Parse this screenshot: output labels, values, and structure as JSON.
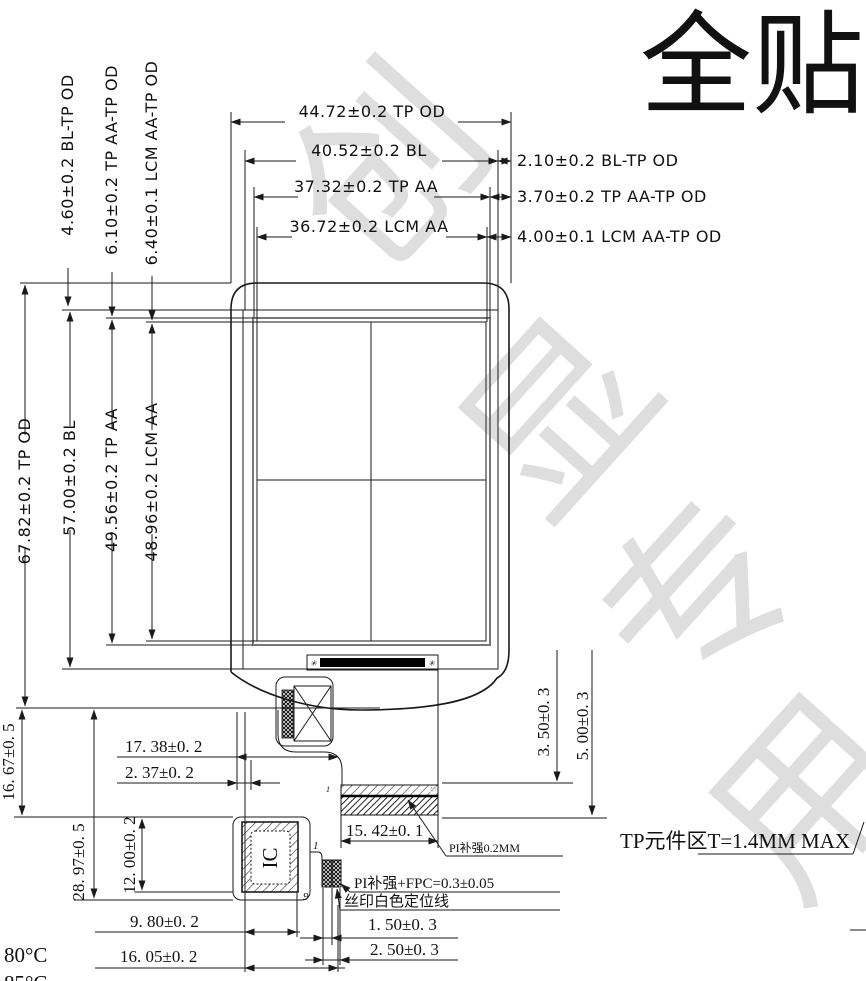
{
  "title": "全贴",
  "watermark": {
    "w1": "创",
    "w2": "显",
    "w3": "专",
    "w4": "用"
  },
  "labels": {
    "d4472": "44.72±0.2 TP OD",
    "d4052": "40.52±0.2 BL",
    "d210": "2.10±0.2 BL-TP OD",
    "d3732": "37.32±0.2 TP AA",
    "d370": "3.70±0.2 TP AA-TP OD",
    "d3672": "36.72±0.2 LCM AA",
    "d400": "4.00±0.1 LCM AA-TP OD",
    "d460": "4.60±0.2 BL-TP OD",
    "d610": "6.10±0.2 TP AA-TP OD",
    "d640": "6.40±0.1 LCM AA-TP OD",
    "d6782": "67.82±0.2 TP OD",
    "d5700": "57.00±0.2 BL",
    "d4956": "49.56±0.2 TP AA",
    "d4896": "48.96±0.2 LCM AA",
    "d1667": "16. 67±0. 5",
    "d2897": "28. 97±0. 5",
    "d1200": "12. 00±0. 2",
    "d1738": "17. 38±0. 2",
    "d237": "2. 37±0. 2",
    "d1542": "15. 42±0. 1",
    "d350": "3. 50±0. 3",
    "d500": "5. 00±0. 3",
    "d980": "9. 80±0. 2",
    "d1605": "16. 05±0. 2",
    "d150": "1. 50±0. 3",
    "d250": "2. 50±0. 3",
    "pi_note": "PI补强0.2MM",
    "pifpc_note": "PI补强+FPC=0.3±0.05",
    "silk_note": "丝印白色定位线",
    "tp_note": "TP元件区T=1.4MM MAX",
    "ic": "IC",
    "pin1a": "1",
    "pin30": "30",
    "pin1b": "1",
    "pin9": "9",
    "temp80": "80°C",
    "temp85": "85°C",
    "mark_a": "✳",
    "mark_b": "✳"
  }
}
